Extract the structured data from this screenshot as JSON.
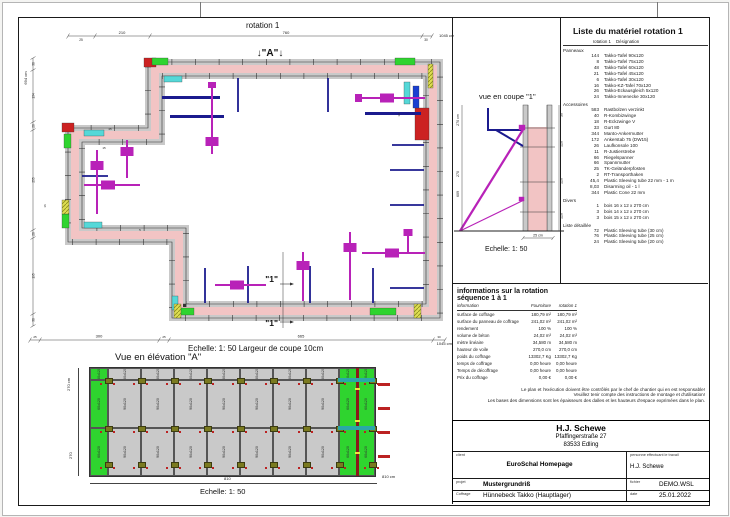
{
  "colors": {
    "wall_pink": "#f2c4c4",
    "panel_gray": "#c9c9c9",
    "green": "#2fd42f",
    "cyan": "#55d8d8",
    "red": "#cc2222",
    "navy": "#1b1b8e",
    "magenta": "#b822b8",
    "yellow": "#dede52"
  },
  "plan": {
    "title": "rotation 1",
    "caption": "Echelle: 1: 50   Largeur de coupe 10cm",
    "marker_a": "↓\"A\"↓",
    "marker_1": "\"1\"",
    "dims": {
      "top": [
        "25",
        "210",
        "760",
        "30"
      ],
      "top_total": "1045 cm",
      "left_total": "694 cm",
      "left": [
        "30",
        "134",
        "20",
        "255",
        "20",
        "195",
        "30"
      ],
      "bottom": [
        "25",
        "300",
        "25",
        "665",
        "30"
      ],
      "bottom_total": "1045 cm",
      "tiny": [
        "15",
        "45",
        "5",
        "16",
        "14"
      ]
    }
  },
  "section": {
    "title": "vue en coupe \"1\"",
    "caption": "Echelle: 1: 50",
    "dims_left": [
      "270 cm",
      "270",
      "609"
    ],
    "dims_right": [
      "30",
      "120",
      "120",
      "120"
    ],
    "dim_bottom": "25 cm"
  },
  "elevation": {
    "title": "Vue en élévation \"A\"",
    "caption": "Echelle: 1: 50",
    "dims_left": [
      "270 cm",
      "270"
    ],
    "dim_bottom": "810",
    "dim_bottom_total": "810 cm",
    "labels": {
      "top": "30x120",
      "mid": "90x120",
      "bottom": "90x120",
      "edge": "60x120"
    }
  },
  "material_list": {
    "title": "Liste du matériel  rotation 1",
    "col_qty": "rotation 1",
    "col_des": "Désignation",
    "sections": [
      {
        "name": "Panneaux",
        "items": [
          [
            "144",
            "Takko-Tafel 90x120"
          ],
          [
            "8",
            "Takko-Tafel 75x120"
          ],
          [
            "48",
            "Takko-Tafel 60x120"
          ],
          [
            "21",
            "Takko-Tafel 45x120"
          ],
          [
            "6",
            "Takko-Tafel 30x120"
          ],
          [
            "16",
            "Takko-KZ-Tafel 70x120"
          ],
          [
            "26",
            "Takko-Eckausgleich 5x120"
          ],
          [
            "24",
            "Takko-Innenecke 30x120"
          ]
        ]
      },
      {
        "name": "Accessoires",
        "items": [
          [
            "583",
            "Rastbolzen verzinkt"
          ],
          [
            "40",
            "R-Kombizwinge"
          ],
          [
            "18",
            "R-Eckzwinge V"
          ],
          [
            "33",
            "Gurt 80"
          ],
          [
            "344",
            "Manto-Ankermutter"
          ],
          [
            "172",
            "Ankerstab 75 (DW15)"
          ],
          [
            "26",
            "Laufkonsole 100"
          ],
          [
            "11",
            "R-Justierstrebe"
          ],
          [
            "66",
            "Riegelspanner"
          ],
          [
            "66",
            "Spannmutter"
          ],
          [
            "25",
            "TK-Geländerpfosten"
          ],
          [
            "2",
            "RT-Transporthaken"
          ],
          [
            "45,4",
            "Plastic Sleeving tube 22 mm - 1 m"
          ],
          [
            "8,03",
            "Disarming oil - 1 l"
          ],
          [
            "344",
            "Plastic Cone 22 mm"
          ]
        ]
      },
      {
        "name": "Divers",
        "items": [
          [
            "1",
            "bois 16 x 12 x 270 cm"
          ],
          [
            "3",
            "bois 14 x 12 x 270 cm"
          ],
          [
            "3",
            "bois 15 x 12 x 270 cm"
          ]
        ]
      },
      {
        "name": "Liste détaillée",
        "items": [
          [
            "72",
            "Plastic Sleeving tube  (30 cm)"
          ],
          [
            "76",
            "Plastic Sleeving tube  (25 cm)"
          ],
          [
            "24",
            "Plastic Sleeving tube  (20 cm)"
          ]
        ]
      }
    ]
  },
  "info_table": {
    "title": "informations sur la rotation  séquence 1 à 1",
    "columns": [
      "information",
      "Fourniture",
      "rotation 1"
    ],
    "rows": [
      [
        "surface de coffrage",
        "180,79 m²",
        "180,79 m²"
      ],
      [
        "surface du panneau de coffrage",
        "241,02 m²",
        "241,02 m²"
      ],
      [
        "rendement",
        "100 %",
        "100 %"
      ],
      [
        "volume de béton",
        "24,02 m³",
        "24,02 m³"
      ],
      [
        "mètre linéaire",
        "34,580 m",
        "34,580 m"
      ],
      [
        "hauteur de voile",
        "270,0 cm",
        "270,0 cm"
      ],
      [
        "poids du coffrage",
        "13302,7 Kg",
        "13302,7 Kg"
      ],
      [
        "temps de coffrage",
        "0,00 heure",
        "0,00 heure"
      ],
      [
        "Temps de décoffrage",
        "0,00 heure",
        "0,00 heure"
      ],
      [
        "Prix du coffrage",
        "0,00 €",
        "0,00 €"
      ]
    ]
  },
  "disclaimer": [
    "Le plan et l'exécution doivent être contrôlés par le chef de chantier qui en est responsable!",
    "Veuillez tenir compte des instructions de montage et d'utilisation!",
    "Les bases des dimensions sont les épaisseurs des dalles et les hauteurs d'espace exprimées dans le plan."
  ],
  "title_block": {
    "company": "H.J. Schewe",
    "address1": "Pfaffingerstraße 27",
    "address2": "83533 Edling",
    "client_label": "client",
    "client": "EuroSchal Homepage",
    "worker_label": "personne effectuant le travail",
    "worker": "H.J. Schewe",
    "project_label": "projet",
    "project": "Mustergrundriß",
    "file_label": "fichier",
    "file": "DEMO.WSL",
    "formwork_label": "Coffrage",
    "formwork": "Hünnebeck Takko (Hauptlager)",
    "date_label": "date",
    "date": "25.01.2022"
  }
}
